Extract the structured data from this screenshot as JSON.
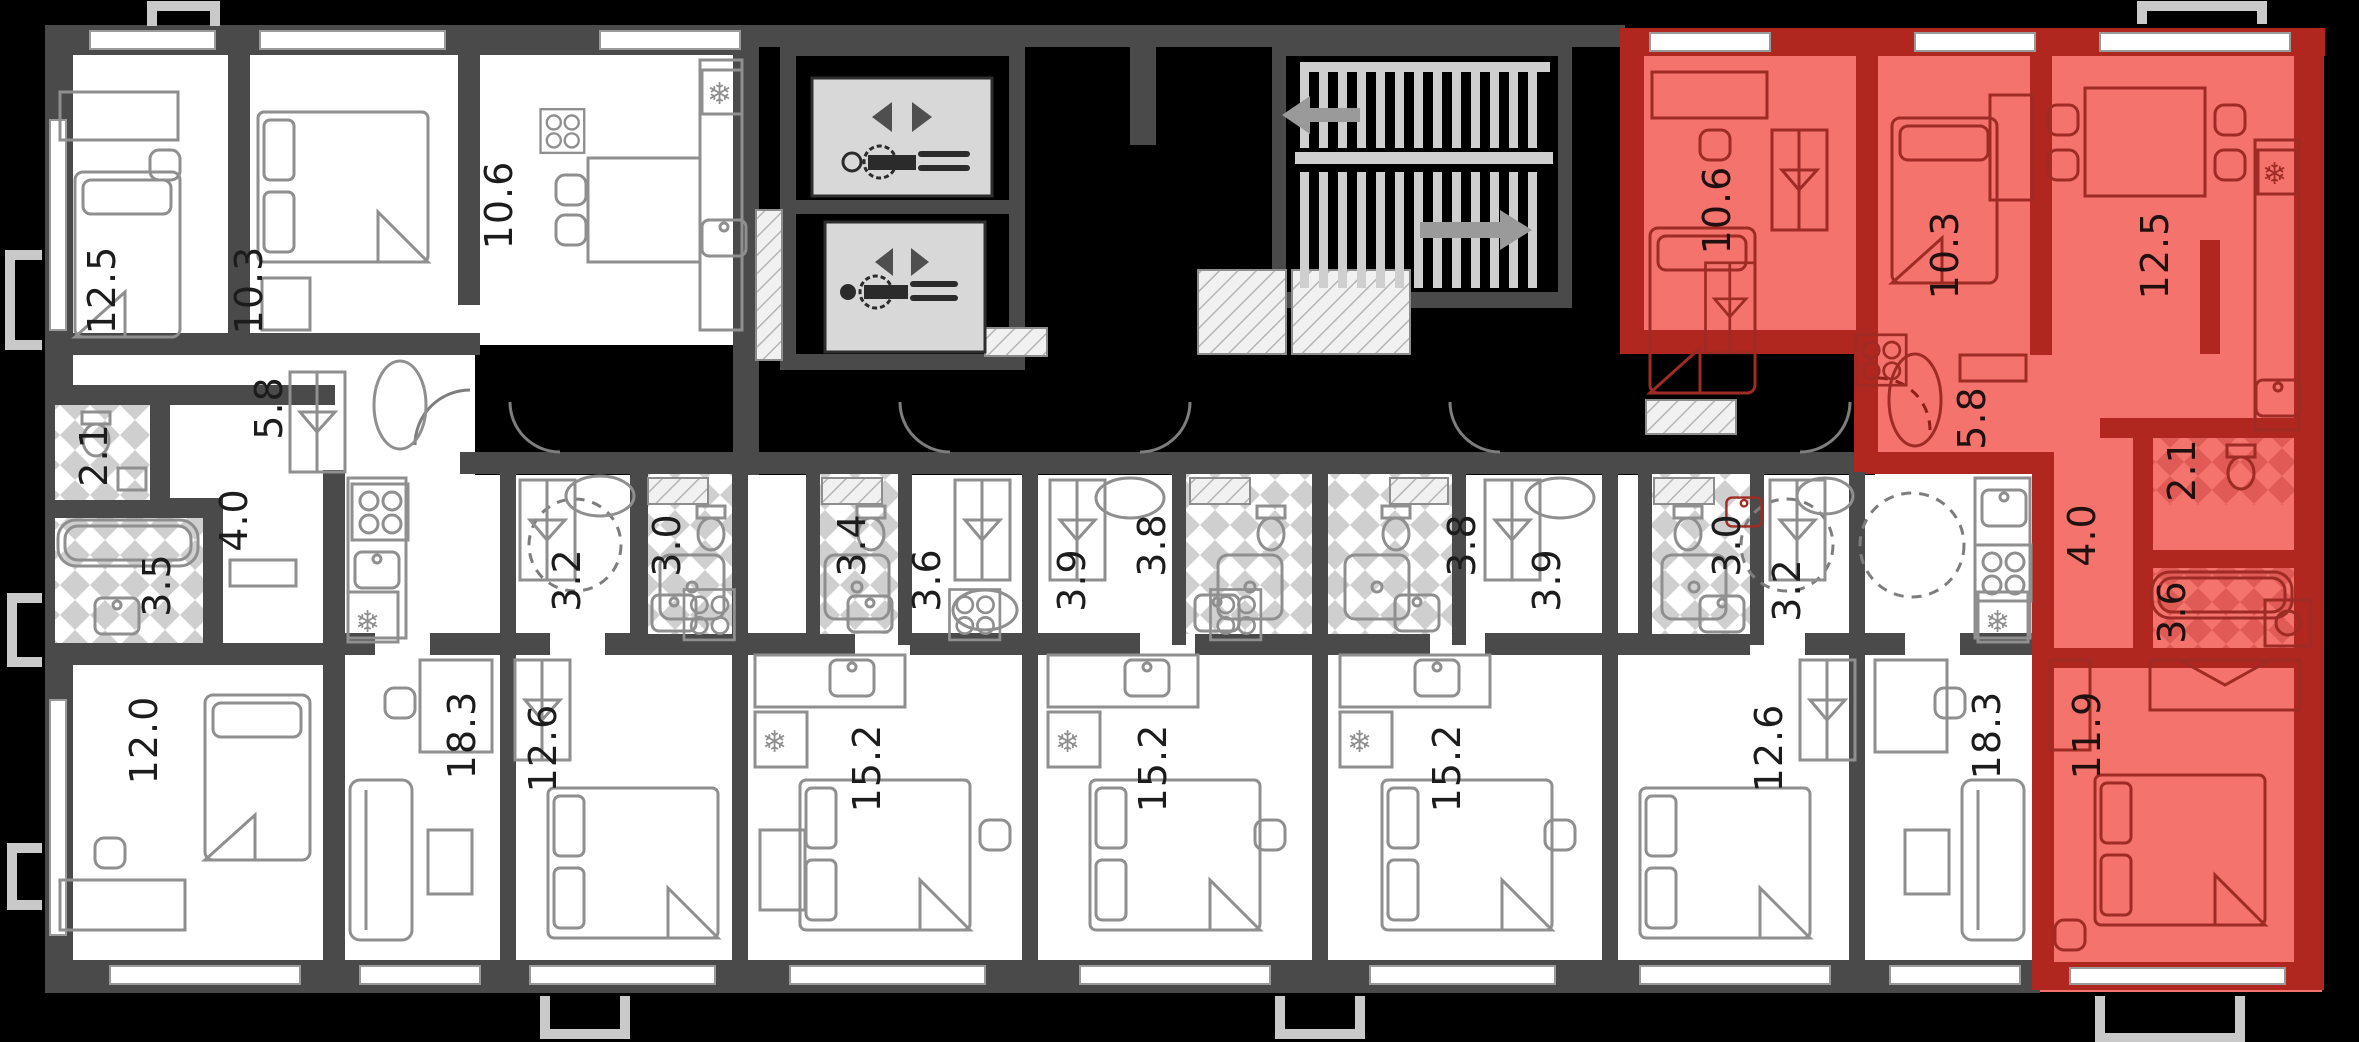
{
  "plan": {
    "kind": "apartment-floor-plan",
    "highlighted_unit": "red-apartment",
    "colors": {
      "background": "#000000",
      "walls": "#4a4a4a",
      "room_fill": "#ffffff",
      "highlight_fill": "#f4736d",
      "highlight_wall": "#b0271f",
      "tile_checker": "#cfcfcf",
      "red_tile_checker": "#e05b55",
      "elevator_cabin": "#d8d8d8",
      "label_color": "#1c1c1c"
    }
  },
  "icons": {
    "snowflake": "❄"
  },
  "rooms": [
    {
      "name": "left-bedroom",
      "area": "12.5"
    },
    {
      "name": "left-bedroom-2",
      "area": "10.3"
    },
    {
      "name": "left-kitchen",
      "area": "10.6"
    },
    {
      "name": "left-hall",
      "area": "5.8"
    },
    {
      "name": "left-wc",
      "area": "2.1"
    },
    {
      "name": "left-corridor",
      "area": "4.0"
    },
    {
      "name": "left-bath",
      "area": "3.5"
    },
    {
      "name": "left-bedroom-3",
      "area": "12.0"
    },
    {
      "name": "left-living",
      "area": "18.3"
    },
    {
      "name": "unit2-hall",
      "area": "3.2"
    },
    {
      "name": "unit2-shower",
      "area": "3.0"
    },
    {
      "name": "unit2-room",
      "area": "12.6"
    },
    {
      "name": "unit3-shower",
      "area": "3.4"
    },
    {
      "name": "unit3-hall",
      "area": "3.6"
    },
    {
      "name": "unit3-room",
      "area": "15.2"
    },
    {
      "name": "unit4-hall",
      "area": "3.9"
    },
    {
      "name": "unit4-shower",
      "area": "3.8"
    },
    {
      "name": "unit4-room",
      "area": "15.2"
    },
    {
      "name": "unit5-shower",
      "area": "3.8"
    },
    {
      "name": "unit5-hall",
      "area": "3.9"
    },
    {
      "name": "unit5-room",
      "area": "15.2"
    },
    {
      "name": "unit6-shower",
      "area": "3.0"
    },
    {
      "name": "unit6-hall",
      "area": "3.2"
    },
    {
      "name": "unit6-room",
      "area": "12.6"
    },
    {
      "name": "unit7-living",
      "area": "18.3"
    },
    {
      "name": "red-bedroom",
      "area": "10.6"
    },
    {
      "name": "red-bedroom-2",
      "area": "10.3"
    },
    {
      "name": "red-kitchen-living",
      "area": "12.5"
    },
    {
      "name": "red-hall",
      "area": "5.8"
    },
    {
      "name": "red-corridor",
      "area": "4.0"
    },
    {
      "name": "red-wc",
      "area": "2.1"
    },
    {
      "name": "red-bath",
      "area": "3.6"
    },
    {
      "name": "red-bedroom-3",
      "area": "11.9"
    }
  ]
}
